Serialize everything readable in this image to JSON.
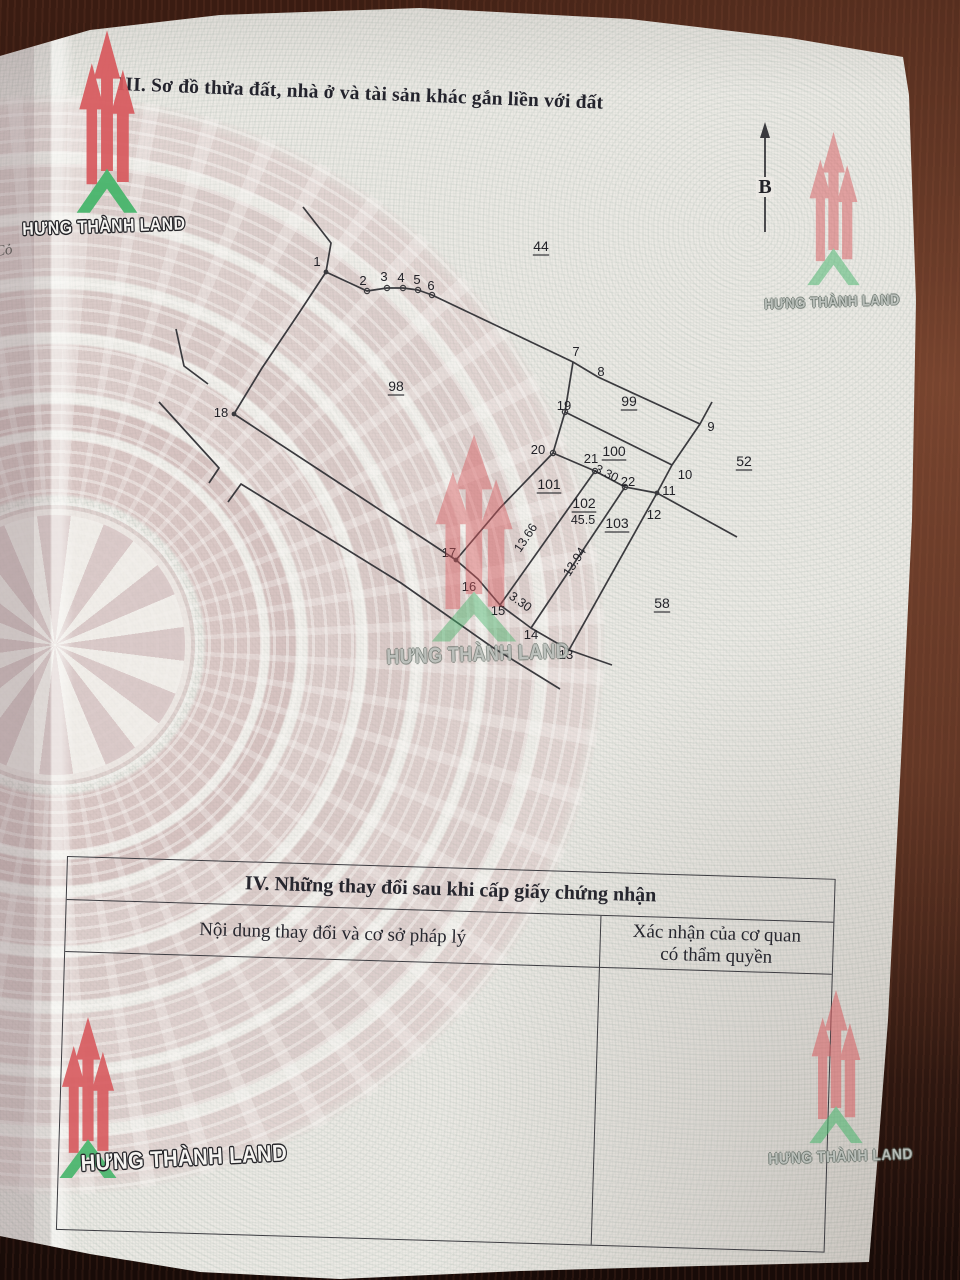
{
  "page": {
    "title": "III. Sơ đồ thửa đất, nhà ở và tài sản khác gắn liền với đất",
    "edge_fragment": "Cỏ"
  },
  "watermark": {
    "brand": "HƯNG THÀNH LAND",
    "arrow_color": "#d85a5e",
    "triangle_color": "#45b56a"
  },
  "diagram": {
    "line_color": "#3a3a3e",
    "north": {
      "label": "B",
      "x": 765,
      "y_top": 122,
      "y_bottom": 232,
      "label_y": 193
    },
    "segments": [
      [
        [
          303,
          207
        ],
        [
          331,
          243
        ],
        [
          326,
          272
        ]
      ],
      [
        [
          326,
          272
        ],
        [
          367,
          291
        ],
        [
          387,
          288
        ],
        [
          403,
          288
        ],
        [
          418,
          290
        ],
        [
          432,
          295
        ],
        [
          573,
          362
        ],
        [
          598,
          377
        ],
        [
          700,
          424
        ]
      ],
      [
        [
          712,
          402
        ],
        [
          700,
          424
        ],
        [
          672,
          465
        ],
        [
          657,
          493
        ]
      ],
      [
        [
          657,
          493
        ],
        [
          737,
          537
        ]
      ],
      [
        [
          565,
          412
        ],
        [
          672,
          465
        ]
      ],
      [
        [
          553,
          453
        ],
        [
          595,
          471
        ],
        [
          625,
          487
        ],
        [
          657,
          493
        ]
      ],
      [
        [
          573,
          362
        ],
        [
          565,
          412
        ],
        [
          553,
          453
        ],
        [
          500,
          508
        ],
        [
          456,
          560
        ]
      ],
      [
        [
          456,
          560
        ],
        [
          478,
          579
        ],
        [
          500,
          605
        ],
        [
          531,
          628
        ],
        [
          569,
          650
        ],
        [
          612,
          665
        ]
      ],
      [
        [
          595,
          471
        ],
        [
          500,
          605
        ]
      ],
      [
        [
          625,
          487
        ],
        [
          531,
          628
        ]
      ],
      [
        [
          657,
          493
        ],
        [
          569,
          650
        ]
      ],
      [
        [
          326,
          272
        ],
        [
          299,
          313
        ],
        [
          262,
          368
        ],
        [
          234,
          414
        ]
      ],
      [
        [
          234,
          414
        ],
        [
          330,
          477
        ],
        [
          456,
          560
        ]
      ],
      [
        [
          176,
          329
        ],
        [
          184,
          366
        ],
        [
          208,
          384
        ]
      ],
      [
        [
          159,
          402
        ],
        [
          219,
          468
        ],
        [
          209,
          483
        ]
      ],
      [
        [
          228,
          502
        ],
        [
          241,
          484
        ],
        [
          401,
          583
        ],
        [
          492,
          647
        ],
        [
          560,
          689
        ]
      ]
    ],
    "dots": [
      [
        326,
        272
      ],
      [
        657,
        493
      ],
      [
        456,
        560
      ],
      [
        234,
        414
      ]
    ],
    "rings": [
      [
        367,
        291
      ],
      [
        387,
        288
      ],
      [
        403,
        288
      ],
      [
        418,
        290
      ],
      [
        432,
        295
      ],
      [
        565,
        412
      ],
      [
        553,
        453
      ],
      [
        595,
        471
      ],
      [
        625,
        487
      ]
    ],
    "point_labels": [
      {
        "t": "1",
        "x": 317,
        "y": 266
      },
      {
        "t": "2",
        "x": 363,
        "y": 285
      },
      {
        "t": "3",
        "x": 384,
        "y": 281
      },
      {
        "t": "4",
        "x": 401,
        "y": 282
      },
      {
        "t": "5",
        "x": 417,
        "y": 284
      },
      {
        "t": "6",
        "x": 431,
        "y": 290
      },
      {
        "t": "7",
        "x": 576,
        "y": 356
      },
      {
        "t": "8",
        "x": 601,
        "y": 376
      },
      {
        "t": "9",
        "x": 711,
        "y": 431
      },
      {
        "t": "10",
        "x": 685,
        "y": 479
      },
      {
        "t": "11",
        "x": 669,
        "y": 495
      },
      {
        "t": "12",
        "x": 654,
        "y": 519
      },
      {
        "t": "13",
        "x": 566,
        "y": 659
      },
      {
        "t": "14",
        "x": 531,
        "y": 639
      },
      {
        "t": "15",
        "x": 498,
        "y": 615
      },
      {
        "t": "16",
        "x": 469,
        "y": 591
      },
      {
        "t": "17",
        "x": 449,
        "y": 557
      },
      {
        "t": "18",
        "x": 221,
        "y": 417
      },
      {
        "t": "19",
        "x": 564,
        "y": 410
      },
      {
        "t": "20",
        "x": 538,
        "y": 454
      },
      {
        "t": "21",
        "x": 591,
        "y": 463
      },
      {
        "t": "22",
        "x": 628,
        "y": 486
      }
    ],
    "parcel_labels": [
      {
        "t": "44",
        "x": 541,
        "y": 251
      },
      {
        "t": "98",
        "x": 396,
        "y": 391
      },
      {
        "t": "99",
        "x": 629,
        "y": 406
      },
      {
        "t": "100",
        "x": 614,
        "y": 456
      },
      {
        "t": "101",
        "x": 549,
        "y": 489
      },
      {
        "t": "102",
        "x": 584,
        "y": 508
      },
      {
        "t": "103",
        "x": 617,
        "y": 528
      },
      {
        "t": "52",
        "x": 744,
        "y": 466
      },
      {
        "t": "58",
        "x": 662,
        "y": 608
      }
    ],
    "measure_labels": [
      {
        "t": "3.30",
        "x": 605,
        "y": 477,
        "r": 26
      },
      {
        "t": "3.30",
        "x": 518,
        "y": 605,
        "r": 36
      },
      {
        "t": "13.66",
        "x": 529,
        "y": 540,
        "r": -56
      },
      {
        "t": "13.94",
        "x": 578,
        "y": 564,
        "r": -57
      },
      {
        "t": "45.5",
        "x": 583,
        "y": 524,
        "r": 0
      }
    ]
  },
  "table": {
    "title": "IV. Những thay đổi sau khi cấp giấy chứng nhận",
    "col1": "Nội dung thay đổi và cơ sở pháp lý",
    "col2_line1": "Xác nhận của cơ quan",
    "col2_line2": "có thẩm quyền"
  }
}
